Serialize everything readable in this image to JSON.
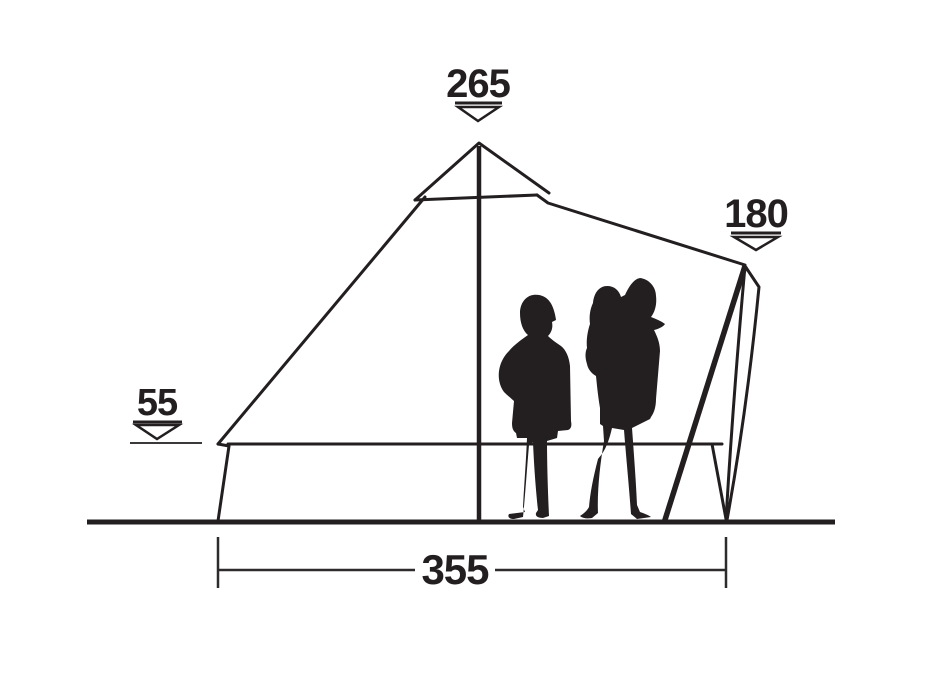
{
  "diagram": {
    "description": "tent-side-view-dimension-diagram",
    "colors": {
      "line": "#231f20",
      "background": "#ffffff"
    },
    "labels": {
      "peak_height": "265",
      "door_height": "180",
      "side_height": "55",
      "floor_width": "355"
    },
    "figures": {
      "left": "adult-silhouette",
      "right": "adult-with-child-silhouette"
    }
  }
}
